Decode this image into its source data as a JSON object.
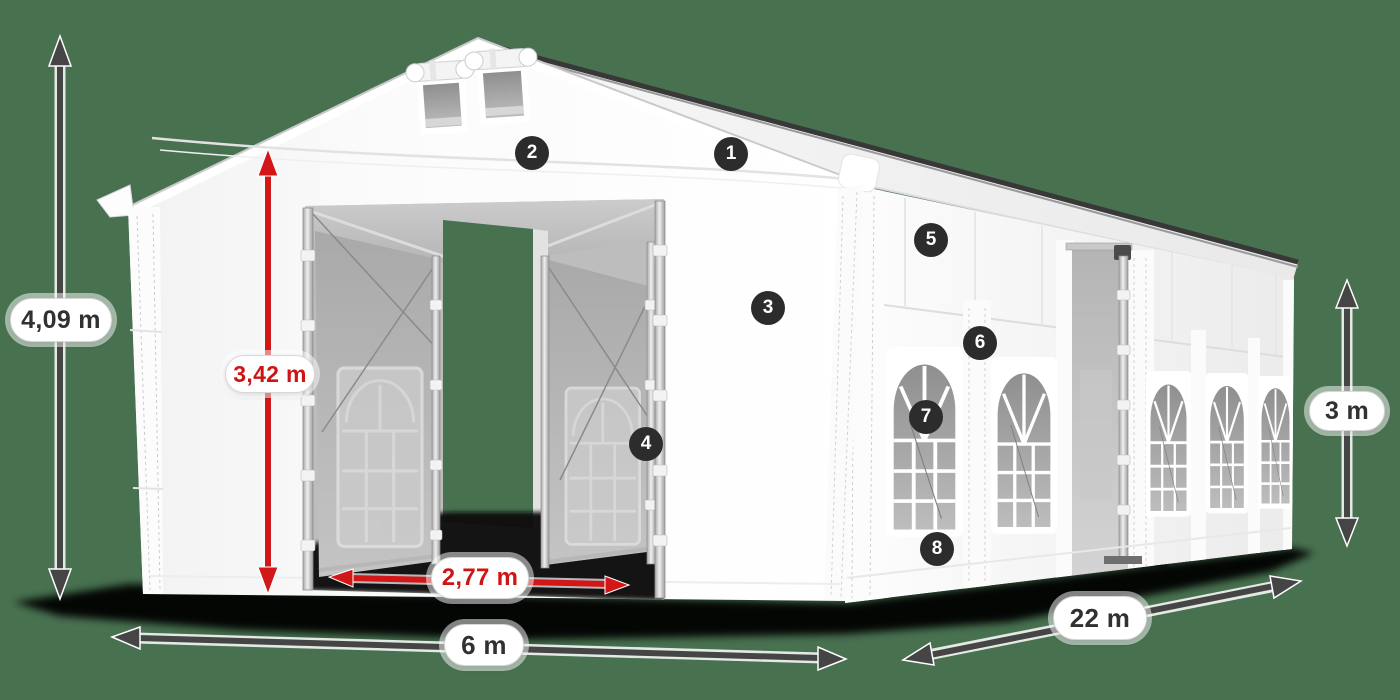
{
  "scene": {
    "background_color": "#487150",
    "tent_color": "#ffffff",
    "accent_red": "#d11717",
    "arrow_gray": "#454545",
    "shadow_color": "#060606"
  },
  "dimensions": [
    {
      "id": "total-height",
      "label": "4,09 m",
      "orientation": "vertical",
      "accent": false
    },
    {
      "id": "entrance-height",
      "label": "3,42 m",
      "orientation": "vertical",
      "accent": true
    },
    {
      "id": "entrance-width",
      "label": "2,77 m",
      "orientation": "horizontal",
      "accent": true
    },
    {
      "id": "front-width",
      "label": "6 m",
      "orientation": "horizontal",
      "accent": false
    },
    {
      "id": "length",
      "label": "22 m",
      "orientation": "diagonal",
      "accent": false
    },
    {
      "id": "side-height",
      "label": "3 m",
      "orientation": "vertical",
      "accent": false
    }
  ],
  "callouts": [
    {
      "number": "1"
    },
    {
      "number": "2"
    },
    {
      "number": "3"
    },
    {
      "number": "4"
    },
    {
      "number": "5"
    },
    {
      "number": "6"
    },
    {
      "number": "7"
    },
    {
      "number": "8"
    }
  ]
}
